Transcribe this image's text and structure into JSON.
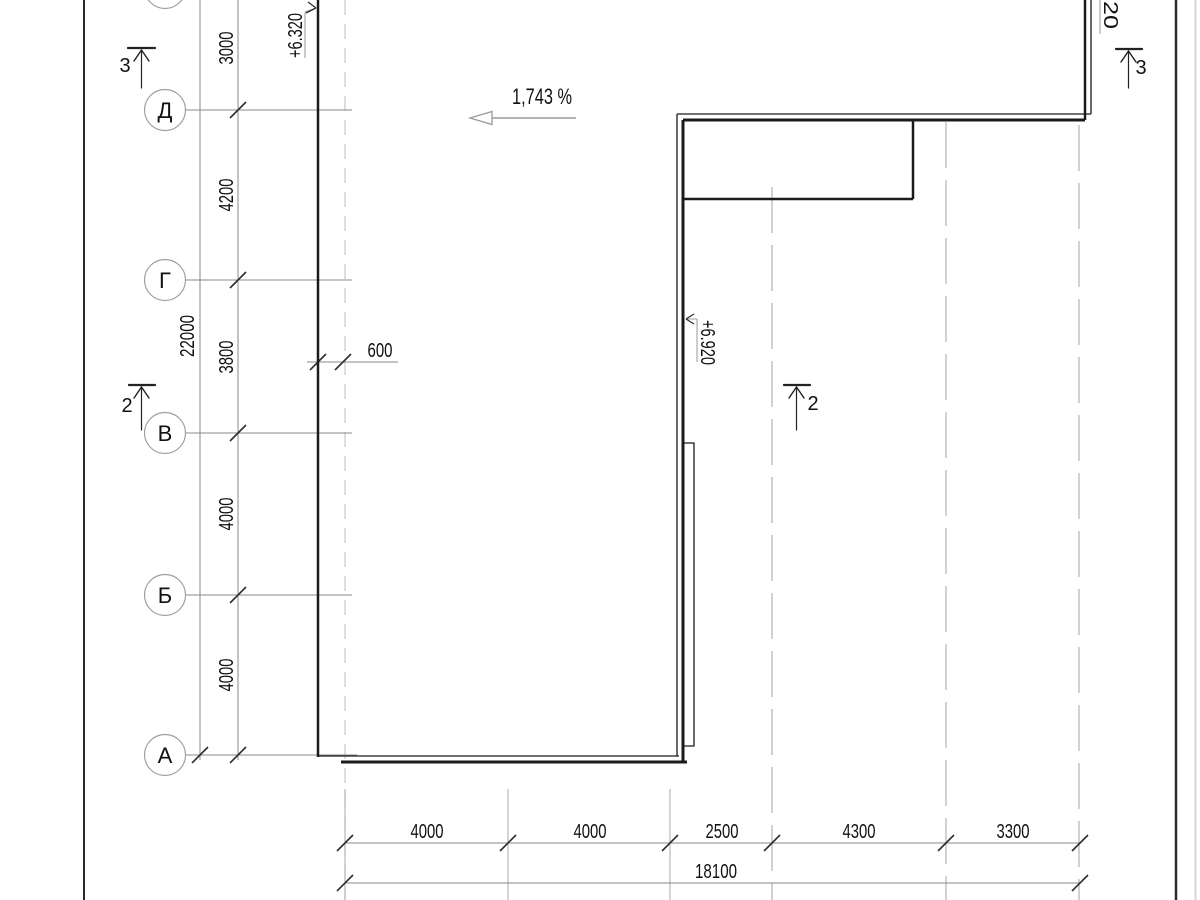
{
  "axes": {
    "rows": [
      "Д",
      "Г",
      "В",
      "Б",
      "А"
    ]
  },
  "dimensions": {
    "left_segments": [
      "3000",
      "4200",
      "3800",
      "4000",
      "4000"
    ],
    "left_total": "22000",
    "offset": "600",
    "bottom_segments": [
      "4000",
      "4000",
      "2500",
      "4300",
      "3300"
    ],
    "bottom_total": "18100"
  },
  "annotations": {
    "slope": "1,743 %",
    "elevation_left": "+6.320",
    "elevation_mid": "+6.920",
    "elevation_top_right": "20"
  },
  "sections": {
    "left_top": "3",
    "left_mid": "2",
    "right_mid": "2",
    "right_top": "3"
  },
  "colors": {
    "building_line": "#1b1b1b",
    "dim_line": "#8a8a8a",
    "axis_dash": "#b8b8b8",
    "text": "#111111"
  }
}
